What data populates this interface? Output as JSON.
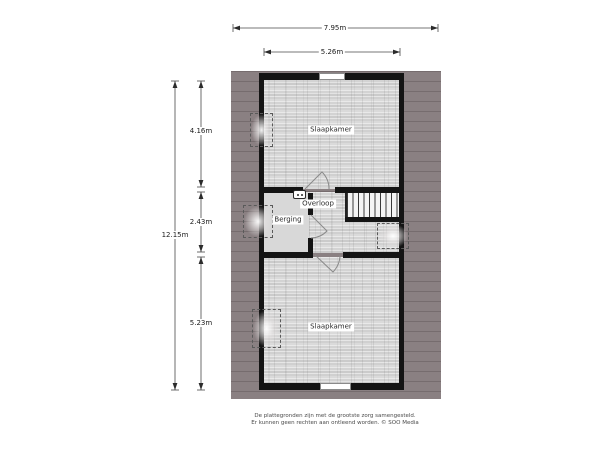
{
  "plan": {
    "dimensions": {
      "outer_width": "7.95m",
      "inner_width": "5.26m",
      "total_height": "12.15m",
      "segment_top": "4.16m",
      "segment_middle": "2.43m",
      "segment_bottom": "5.23m"
    },
    "rooms": {
      "bedroom_top": "Slaapkamer",
      "storage": "Berging",
      "landing": "Overloop",
      "bedroom_bottom": "Slaapkamer"
    },
    "icons": {
      "ventilation_unit": "mv-unit-icon",
      "roof_window": "roof-window-dashed-icon",
      "stairs": "stairs-icon",
      "door": "door-swing-icon"
    },
    "colors": {
      "roof_area": "#8a8082",
      "wall": "#141414",
      "wood_floor": "#dcdcdc",
      "storage_floor": "#d8d8d8",
      "background": "#ffffff"
    },
    "disclaimer": {
      "line1": "De plattegronden zijn met de grootste zorg samengesteld.",
      "line2": "Er kunnen geen rechten aan ontleend worden. © SOO Media"
    }
  }
}
